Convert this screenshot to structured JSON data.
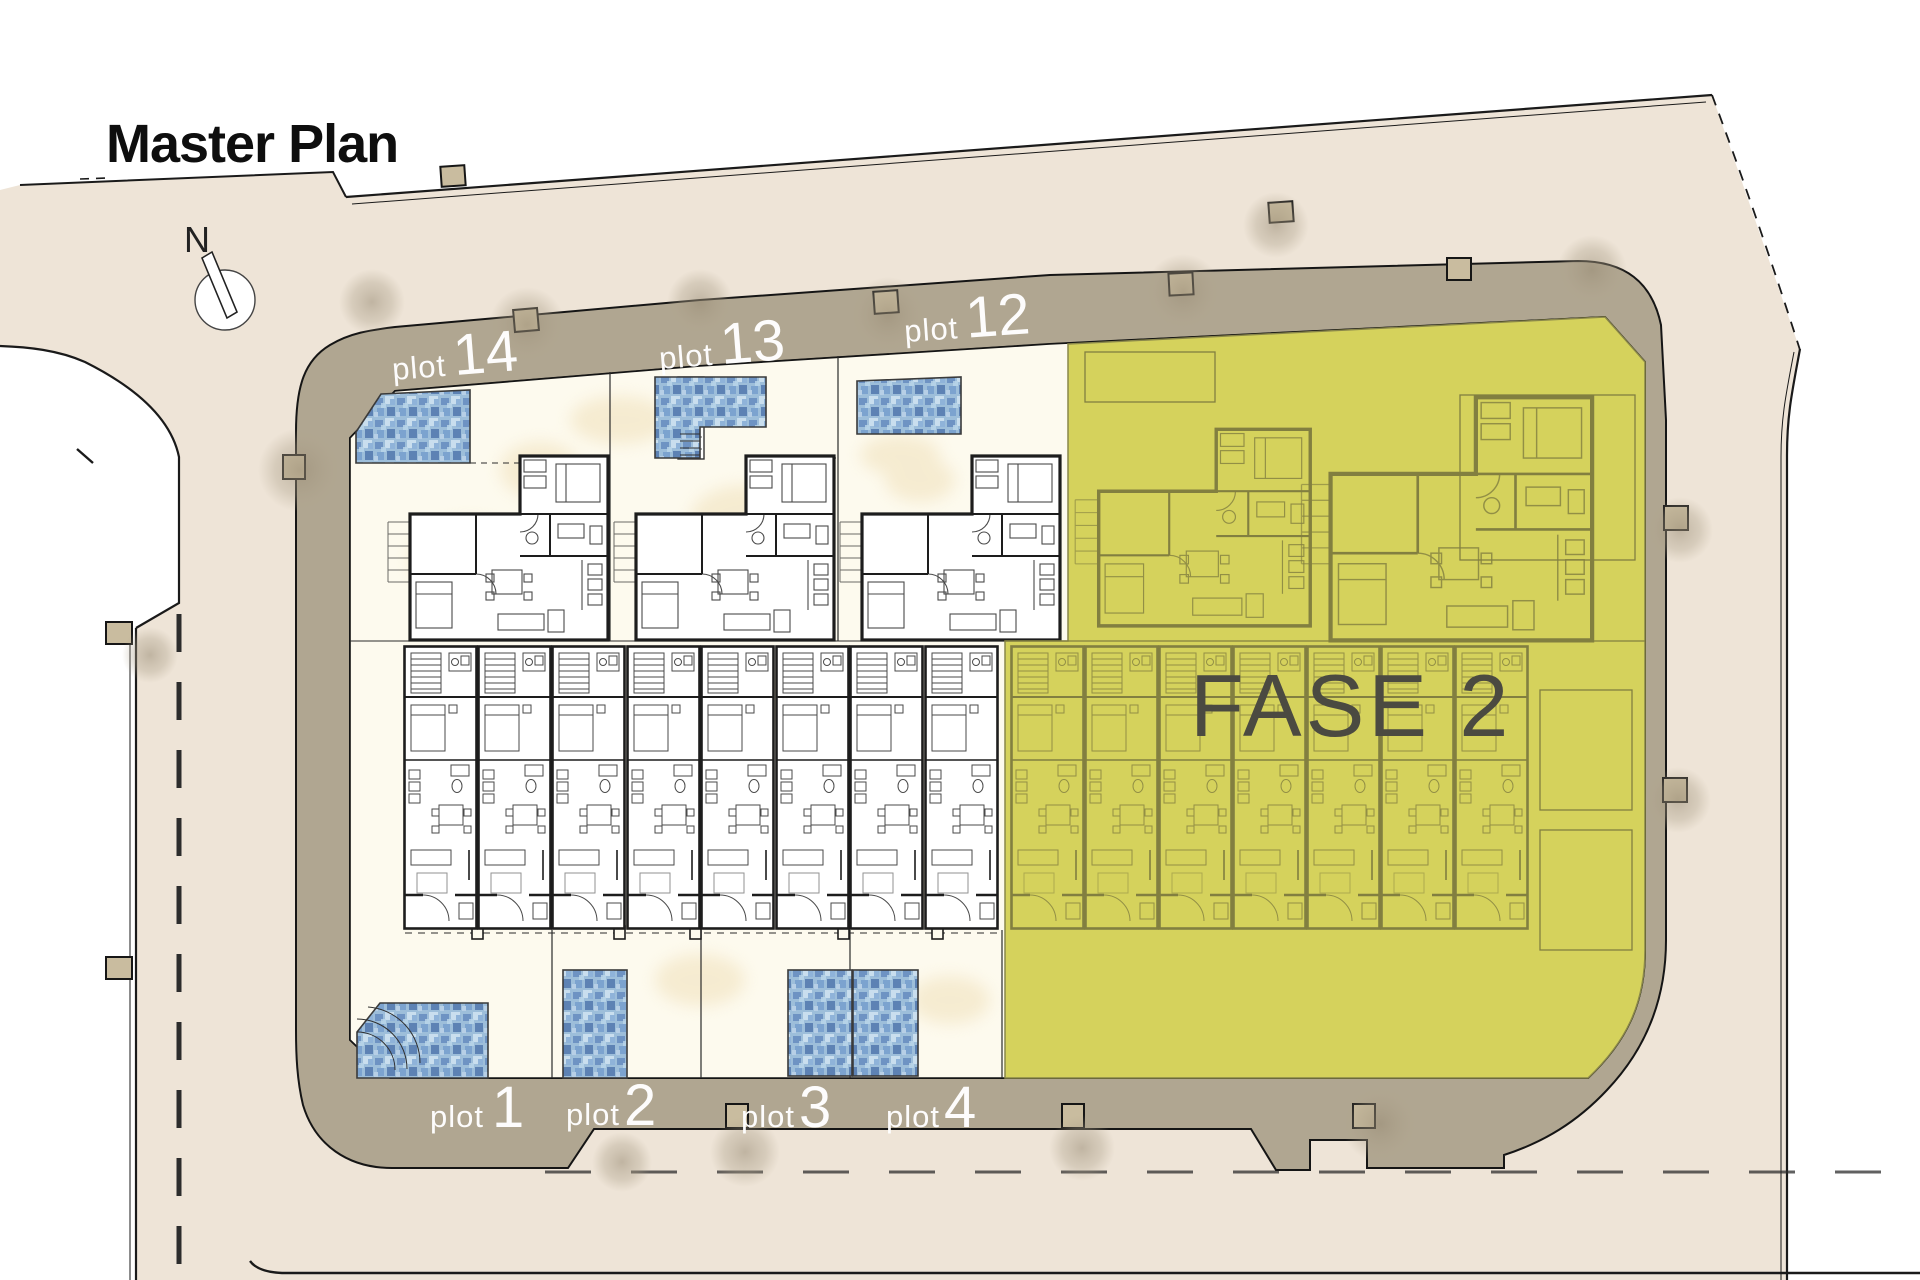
{
  "title": "Master Plan",
  "compass": {
    "label": "N"
  },
  "phase": {
    "label": "FASE 2"
  },
  "plots_top": [
    {
      "prefix": "plot",
      "number": "14"
    },
    {
      "prefix": "plot",
      "number": "13"
    },
    {
      "prefix": "plot",
      "number": "12"
    }
  ],
  "plots_bottom": [
    {
      "prefix": "plot",
      "number": "1"
    },
    {
      "prefix": "plot",
      "number": "2"
    },
    {
      "prefix": "plot",
      "number": "3"
    },
    {
      "prefix": "plot",
      "number": "4"
    }
  ],
  "colors": {
    "street_beige": "#eee4d7",
    "road_band": "#b0a691",
    "plot_cream": "#fdfaee",
    "phase_yellow": "#d5d25c",
    "phase_line_olive": "#827f40",
    "phase_text": "#4b4a41",
    "pool_blue": "#9dbeda",
    "wall_black": "#1d1d1d",
    "label_white": "#ffffff",
    "marker_tan": "#c9bc9f"
  }
}
